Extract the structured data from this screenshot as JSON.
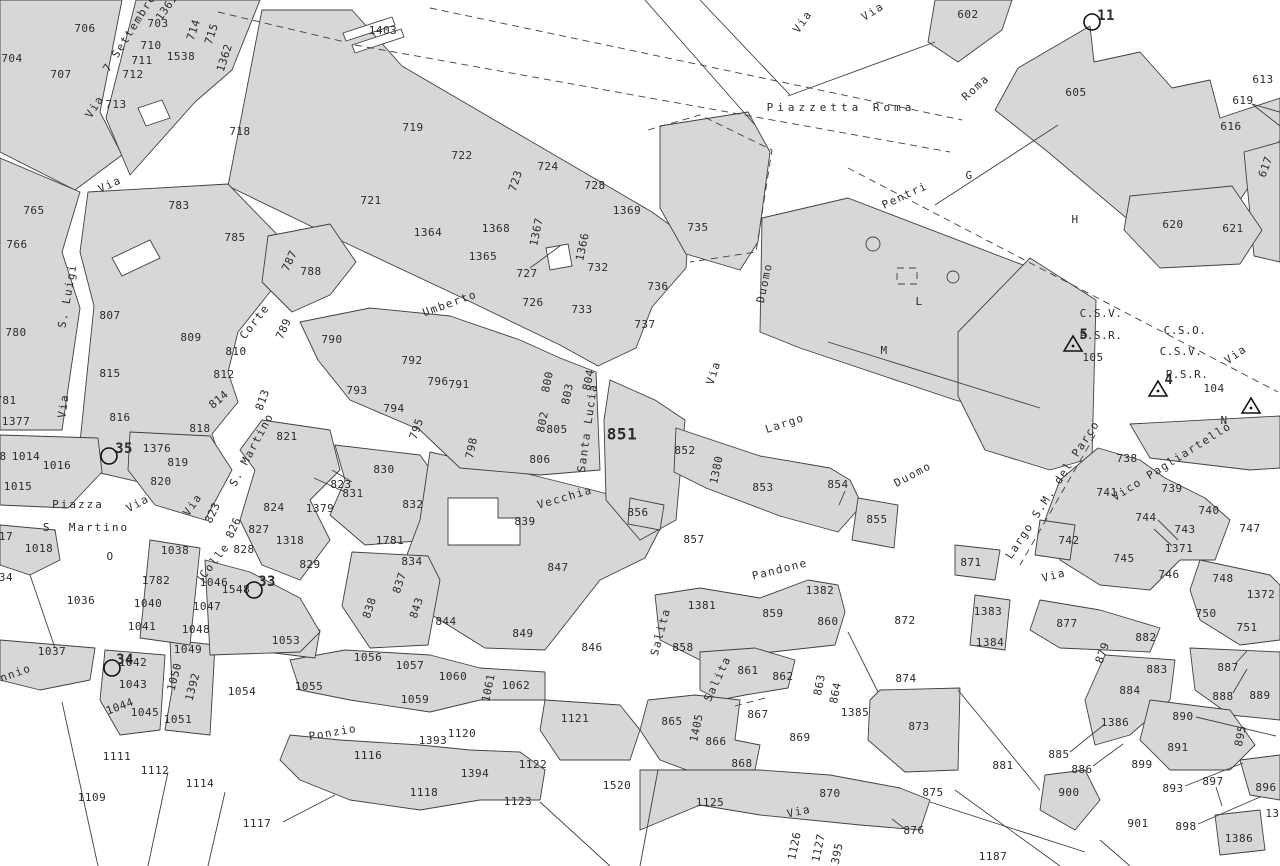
{
  "map": {
    "type": "cadastral-map",
    "background": "#ffffff",
    "parcel_fill": "#d7d7d7",
    "line_color": "#404040",
    "text_color": "#2b2b2b"
  },
  "streets": [
    {
      "t": "7 Settembre",
      "x": 130,
      "y": 33,
      "r": -58
    },
    {
      "t": "Via",
      "x": 95,
      "y": 107,
      "r": -58
    },
    {
      "t": "Via",
      "x": 110,
      "y": 185,
      "r": -25
    },
    {
      "t": "Via",
      "x": 803,
      "y": 22,
      "r": -55
    },
    {
      "t": "Via",
      "x": 873,
      "y": 12,
      "r": -32
    },
    {
      "t": "Roma",
      "x": 976,
      "y": 88,
      "r": -42
    },
    {
      "t": "Pentri",
      "x": 905,
      "y": 196,
      "r": -25
    },
    {
      "t": "Umberto",
      "x": 450,
      "y": 304,
      "r": -20
    },
    {
      "t": "Duomo",
      "x": 765,
      "y": 283,
      "r": -78
    },
    {
      "t": "Via",
      "x": 714,
      "y": 373,
      "r": -72
    },
    {
      "t": "Largo",
      "x": 785,
      "y": 424,
      "r": -18
    },
    {
      "t": "Duomo",
      "x": 913,
      "y": 475,
      "r": -28
    },
    {
      "t": "S. Luigi",
      "x": 68,
      "y": 296,
      "r": -80
    },
    {
      "t": "Corte",
      "x": 255,
      "y": 322,
      "r": -52
    },
    {
      "t": "Via",
      "x": 64,
      "y": 406,
      "r": -82
    },
    {
      "t": "S. Martino",
      "x": 252,
      "y": 450,
      "r": -62
    },
    {
      "t": "Via",
      "x": 138,
      "y": 504,
      "r": -28
    },
    {
      "t": "Via",
      "x": 193,
      "y": 505,
      "r": -55
    },
    {
      "t": "Colle",
      "x": 215,
      "y": 561,
      "r": -52
    },
    {
      "t": "Vecchia",
      "x": 565,
      "y": 498,
      "r": -16
    },
    {
      "t": "Santa Lucia",
      "x": 588,
      "y": 428,
      "r": -82
    },
    {
      "t": "Pandone",
      "x": 780,
      "y": 570,
      "r": -14
    },
    {
      "t": "Salita",
      "x": 661,
      "y": 632,
      "r": -75
    },
    {
      "t": "Salita",
      "x": 718,
      "y": 679,
      "r": -65
    },
    {
      "t": "Ponzio",
      "x": 333,
      "y": 733,
      "r": -10
    },
    {
      "t": "ennio",
      "x": 12,
      "y": 675,
      "r": -20
    },
    {
      "t": "Via",
      "x": 1054,
      "y": 576,
      "r": -14
    },
    {
      "t": "Via",
      "x": 1236,
      "y": 355,
      "r": -35
    },
    {
      "t": "Vico Pagliartello",
      "x": 1172,
      "y": 462,
      "r": -32
    },
    {
      "t": "Largo S.M. del Parco",
      "x": 1053,
      "y": 490,
      "r": -57
    },
    {
      "t": "Via",
      "x": 799,
      "y": 812,
      "r": -12
    }
  ],
  "places": [
    {
      "t": "Piazzetta Roma",
      "x": 841,
      "y": 108,
      "sp": 4
    },
    {
      "t": "Piazza",
      "x": 78,
      "y": 505,
      "sp": 2
    },
    {
      "t": "S. Martino",
      "x": 86,
      "y": 528,
      "sp": 2
    }
  ],
  "areas": [
    {
      "t": "G",
      "x": 969,
      "y": 176
    },
    {
      "t": "H",
      "x": 1075,
      "y": 220
    },
    {
      "t": "M",
      "x": 884,
      "y": 351
    },
    {
      "t": "L",
      "x": 919,
      "y": 302
    },
    {
      "t": "N",
      "x": 1224,
      "y": 421
    },
    {
      "t": "O",
      "x": 110,
      "y": 557
    },
    {
      "t": "C.S.V.",
      "x": 1101,
      "y": 314
    },
    {
      "t": "P.S.R.",
      "x": 1101,
      "y": 336
    },
    {
      "t": "105",
      "x": 1093,
      "y": 358
    },
    {
      "t": "C.S.O.",
      "x": 1185,
      "y": 331
    },
    {
      "t": "C.S.V.",
      "x": 1181,
      "y": 352
    },
    {
      "t": "P.S.R.",
      "x": 1187,
      "y": 375
    },
    {
      "t": "104",
      "x": 1214,
      "y": 389
    }
  ],
  "parcels": [
    {
      "t": "706",
      "x": 85,
      "y": 29
    },
    {
      "t": "703",
      "x": 158,
      "y": 24
    },
    {
      "t": "1361",
      "x": 167,
      "y": 8,
      "r": -55
    },
    {
      "t": "714",
      "x": 194,
      "y": 30,
      "r": -72
    },
    {
      "t": "715",
      "x": 212,
      "y": 34,
      "r": -72
    },
    {
      "t": "710",
      "x": 151,
      "y": 46
    },
    {
      "t": "1538",
      "x": 181,
      "y": 57
    },
    {
      "t": "711",
      "x": 142,
      "y": 61
    },
    {
      "t": "1362",
      "x": 225,
      "y": 58,
      "r": -72
    },
    {
      "t": "712",
      "x": 133,
      "y": 75
    },
    {
      "t": "704",
      "x": 12,
      "y": 59
    },
    {
      "t": "707",
      "x": 61,
      "y": 75
    },
    {
      "t": "713",
      "x": 116,
      "y": 105
    },
    {
      "t": "718",
      "x": 240,
      "y": 132
    },
    {
      "t": "1403",
      "x": 383,
      "y": 31
    },
    {
      "t": "719",
      "x": 413,
      "y": 128
    },
    {
      "t": "722",
      "x": 462,
      "y": 156
    },
    {
      "t": "721",
      "x": 371,
      "y": 201
    },
    {
      "t": "723",
      "x": 516,
      "y": 181,
      "r": -72
    },
    {
      "t": "724",
      "x": 548,
      "y": 167
    },
    {
      "t": "728",
      "x": 595,
      "y": 186
    },
    {
      "t": "1369",
      "x": 627,
      "y": 211
    },
    {
      "t": "765",
      "x": 34,
      "y": 211
    },
    {
      "t": "783",
      "x": 179,
      "y": 206
    },
    {
      "t": "766",
      "x": 17,
      "y": 245
    },
    {
      "t": "785",
      "x": 235,
      "y": 238
    },
    {
      "t": "787",
      "x": 290,
      "y": 261,
      "r": -65
    },
    {
      "t": "788",
      "x": 311,
      "y": 272
    },
    {
      "t": "807",
      "x": 110,
      "y": 316
    },
    {
      "t": "780",
      "x": 16,
      "y": 333
    },
    {
      "t": "809",
      "x": 191,
      "y": 338
    },
    {
      "t": "810",
      "x": 236,
      "y": 352
    },
    {
      "t": "789",
      "x": 284,
      "y": 329,
      "r": -65
    },
    {
      "t": "812",
      "x": 224,
      "y": 375
    },
    {
      "t": "815",
      "x": 110,
      "y": 374
    },
    {
      "t": "814",
      "x": 219,
      "y": 400,
      "r": -40
    },
    {
      "t": "813",
      "x": 263,
      "y": 400,
      "r": -70
    },
    {
      "t": "781",
      "x": 6,
      "y": 401
    },
    {
      "t": "1377",
      "x": 16,
      "y": 422
    },
    {
      "t": "816",
      "x": 120,
      "y": 418
    },
    {
      "t": "818",
      "x": 200,
      "y": 429
    },
    {
      "t": "1364",
      "x": 428,
      "y": 233
    },
    {
      "t": "1368",
      "x": 496,
      "y": 229
    },
    {
      "t": "1367",
      "x": 537,
      "y": 232,
      "r": -78
    },
    {
      "t": "1366",
      "x": 583,
      "y": 247,
      "r": -78
    },
    {
      "t": "1365",
      "x": 483,
      "y": 257
    },
    {
      "t": "727",
      "x": 527,
      "y": 274
    },
    {
      "t": "732",
      "x": 598,
      "y": 268
    },
    {
      "t": "726",
      "x": 533,
      "y": 303
    },
    {
      "t": "733",
      "x": 582,
      "y": 310
    },
    {
      "t": "790",
      "x": 332,
      "y": 340
    },
    {
      "t": "792",
      "x": 412,
      "y": 361
    },
    {
      "t": "796",
      "x": 438,
      "y": 382
    },
    {
      "t": "791",
      "x": 459,
      "y": 385
    },
    {
      "t": "793",
      "x": 357,
      "y": 391
    },
    {
      "t": "794",
      "x": 394,
      "y": 409
    },
    {
      "t": "795",
      "x": 417,
      "y": 429,
      "r": -70
    },
    {
      "t": "800",
      "x": 548,
      "y": 382,
      "r": -78
    },
    {
      "t": "803",
      "x": 568,
      "y": 394,
      "r": -78
    },
    {
      "t": "804",
      "x": 589,
      "y": 380,
      "r": -78
    },
    {
      "t": "802",
      "x": 543,
      "y": 422,
      "r": -78
    },
    {
      "t": "805",
      "x": 557,
      "y": 430
    },
    {
      "t": "806",
      "x": 540,
      "y": 460
    },
    {
      "t": "735",
      "x": 698,
      "y": 228
    },
    {
      "t": "736",
      "x": 658,
      "y": 287
    },
    {
      "t": "737",
      "x": 645,
      "y": 325
    },
    {
      "t": "602",
      "x": 968,
      "y": 15
    },
    {
      "t": "605",
      "x": 1076,
      "y": 93
    },
    {
      "t": "613",
      "x": 1263,
      "y": 80
    },
    {
      "t": "619",
      "x": 1243,
      "y": 101
    },
    {
      "t": "616",
      "x": 1231,
      "y": 127
    },
    {
      "t": "617",
      "x": 1266,
      "y": 167,
      "r": -70
    },
    {
      "t": "620",
      "x": 1173,
      "y": 225
    },
    {
      "t": "621",
      "x": 1233,
      "y": 229
    },
    {
      "t": "8",
      "x": 3,
      "y": 457
    },
    {
      "t": "1014",
      "x": 26,
      "y": 457
    },
    {
      "t": "1016",
      "x": 57,
      "y": 466
    },
    {
      "t": "1015",
      "x": 18,
      "y": 487
    },
    {
      "t": "1376",
      "x": 157,
      "y": 449
    },
    {
      "t": "819",
      "x": 178,
      "y": 463
    },
    {
      "t": "820",
      "x": 161,
      "y": 482
    },
    {
      "t": "821",
      "x": 287,
      "y": 437
    },
    {
      "t": "823",
      "x": 213,
      "y": 513,
      "r": -65
    },
    {
      "t": "824",
      "x": 274,
      "y": 508
    },
    {
      "t": "826",
      "x": 234,
      "y": 528,
      "r": -65
    },
    {
      "t": "827",
      "x": 259,
      "y": 530
    },
    {
      "t": "828",
      "x": 244,
      "y": 550
    },
    {
      "t": "1318",
      "x": 290,
      "y": 541
    },
    {
      "t": "829",
      "x": 310,
      "y": 565
    },
    {
      "t": "17",
      "x": 6,
      "y": 537
    },
    {
      "t": "1018",
      "x": 39,
      "y": 549
    },
    {
      "t": "34",
      "x": 6,
      "y": 578
    },
    {
      "t": "1036",
      "x": 81,
      "y": 601
    },
    {
      "t": "1038",
      "x": 175,
      "y": 551
    },
    {
      "t": "1782",
      "x": 156,
      "y": 581
    },
    {
      "t": "1046",
      "x": 214,
      "y": 583
    },
    {
      "t": "1548",
      "x": 236,
      "y": 590
    },
    {
      "t": "1040",
      "x": 148,
      "y": 604
    },
    {
      "t": "1047",
      "x": 207,
      "y": 607
    },
    {
      "t": "1041",
      "x": 142,
      "y": 627
    },
    {
      "t": "1048",
      "x": 196,
      "y": 630
    },
    {
      "t": "1053",
      "x": 286,
      "y": 641
    },
    {
      "t": "798",
      "x": 472,
      "y": 448,
      "r": -78
    },
    {
      "t": "830",
      "x": 384,
      "y": 470
    },
    {
      "t": "823",
      "x": 341,
      "y": 485
    },
    {
      "t": "831",
      "x": 353,
      "y": 494
    },
    {
      "t": "832",
      "x": 413,
      "y": 505
    },
    {
      "t": "1379",
      "x": 320,
      "y": 509
    },
    {
      "t": "839",
      "x": 525,
      "y": 522
    },
    {
      "t": "1781",
      "x": 390,
      "y": 541
    },
    {
      "t": "834",
      "x": 412,
      "y": 562
    },
    {
      "t": "837",
      "x": 400,
      "y": 583,
      "r": -72
    },
    {
      "t": "838",
      "x": 370,
      "y": 608,
      "r": -72
    },
    {
      "t": "843",
      "x": 417,
      "y": 608,
      "r": -72
    },
    {
      "t": "844",
      "x": 446,
      "y": 622
    },
    {
      "t": "849",
      "x": 523,
      "y": 634
    },
    {
      "t": "847",
      "x": 558,
      "y": 568
    },
    {
      "t": "851",
      "x": 622,
      "y": 435,
      "s": 16,
      "w": 600
    },
    {
      "t": "856",
      "x": 638,
      "y": 513
    },
    {
      "t": "852",
      "x": 685,
      "y": 451
    },
    {
      "t": "1380",
      "x": 717,
      "y": 470,
      "r": -78
    },
    {
      "t": "853",
      "x": 763,
      "y": 488
    },
    {
      "t": "854",
      "x": 838,
      "y": 485
    },
    {
      "t": "855",
      "x": 877,
      "y": 520
    },
    {
      "t": "857",
      "x": 694,
      "y": 540
    },
    {
      "t": "1382",
      "x": 820,
      "y": 591
    },
    {
      "t": "1381",
      "x": 702,
      "y": 606
    },
    {
      "t": "859",
      "x": 773,
      "y": 614
    },
    {
      "t": "860",
      "x": 828,
      "y": 622
    },
    {
      "t": "872",
      "x": 905,
      "y": 621
    },
    {
      "t": "858",
      "x": 683,
      "y": 648
    },
    {
      "t": "738",
      "x": 1127,
      "y": 459
    },
    {
      "t": "741",
      "x": 1107,
      "y": 493
    },
    {
      "t": "739",
      "x": 1172,
      "y": 489
    },
    {
      "t": "740",
      "x": 1209,
      "y": 511
    },
    {
      "t": "744",
      "x": 1146,
      "y": 518
    },
    {
      "t": "743",
      "x": 1185,
      "y": 530
    },
    {
      "t": "742",
      "x": 1069,
      "y": 541
    },
    {
      "t": "1371",
      "x": 1179,
      "y": 549
    },
    {
      "t": "745",
      "x": 1124,
      "y": 559
    },
    {
      "t": "746",
      "x": 1169,
      "y": 575
    },
    {
      "t": "747",
      "x": 1250,
      "y": 529
    },
    {
      "t": "748",
      "x": 1223,
      "y": 579
    },
    {
      "t": "1372",
      "x": 1261,
      "y": 595
    },
    {
      "t": "871",
      "x": 971,
      "y": 563
    },
    {
      "t": "750",
      "x": 1206,
      "y": 614
    },
    {
      "t": "751",
      "x": 1247,
      "y": 628
    },
    {
      "t": "1383",
      "x": 988,
      "y": 612
    },
    {
      "t": "877",
      "x": 1067,
      "y": 624
    },
    {
      "t": "1384",
      "x": 990,
      "y": 643
    },
    {
      "t": "882",
      "x": 1146,
      "y": 638
    },
    {
      "t": "879",
      "x": 1103,
      "y": 653,
      "r": -70
    },
    {
      "t": "1037",
      "x": 52,
      "y": 652
    },
    {
      "t": "1042",
      "x": 133,
      "y": 663
    },
    {
      "t": "1043",
      "x": 133,
      "y": 685
    },
    {
      "t": "1044",
      "x": 120,
      "y": 707,
      "r": -20
    },
    {
      "t": "1045",
      "x": 145,
      "y": 713
    },
    {
      "t": "1049",
      "x": 188,
      "y": 650
    },
    {
      "t": "1050",
      "x": 175,
      "y": 677,
      "r": -75
    },
    {
      "t": "1392",
      "x": 193,
      "y": 687,
      "r": -75
    },
    {
      "t": "1051",
      "x": 178,
      "y": 720
    },
    {
      "t": "1054",
      "x": 242,
      "y": 692
    },
    {
      "t": "1055",
      "x": 309,
      "y": 687
    },
    {
      "t": "1111",
      "x": 117,
      "y": 757
    },
    {
      "t": "1112",
      "x": 155,
      "y": 771
    },
    {
      "t": "1114",
      "x": 200,
      "y": 784
    },
    {
      "t": "1109",
      "x": 92,
      "y": 798
    },
    {
      "t": "1117",
      "x": 257,
      "y": 824
    },
    {
      "t": "1056",
      "x": 368,
      "y": 658
    },
    {
      "t": "1057",
      "x": 410,
      "y": 666
    },
    {
      "t": "1060",
      "x": 453,
      "y": 677
    },
    {
      "t": "1061",
      "x": 489,
      "y": 688,
      "r": -78
    },
    {
      "t": "1062",
      "x": 516,
      "y": 686
    },
    {
      "t": "1059",
      "x": 415,
      "y": 700
    },
    {
      "t": "1116",
      "x": 368,
      "y": 756
    },
    {
      "t": "1393",
      "x": 433,
      "y": 741
    },
    {
      "t": "1120",
      "x": 462,
      "y": 734
    },
    {
      "t": "1118",
      "x": 424,
      "y": 793
    },
    {
      "t": "1394",
      "x": 475,
      "y": 774
    },
    {
      "t": "1122",
      "x": 533,
      "y": 765
    },
    {
      "t": "1121",
      "x": 575,
      "y": 719
    },
    {
      "t": "1123",
      "x": 518,
      "y": 802
    },
    {
      "t": "1520",
      "x": 617,
      "y": 786
    },
    {
      "t": "846",
      "x": 592,
      "y": 648
    },
    {
      "t": "861",
      "x": 748,
      "y": 671
    },
    {
      "t": "862",
      "x": 783,
      "y": 677
    },
    {
      "t": "863",
      "x": 820,
      "y": 685,
      "r": -78
    },
    {
      "t": "864",
      "x": 836,
      "y": 693,
      "r": -78
    },
    {
      "t": "874",
      "x": 906,
      "y": 679
    },
    {
      "t": "1385",
      "x": 855,
      "y": 713
    },
    {
      "t": "873",
      "x": 919,
      "y": 727
    },
    {
      "t": "865",
      "x": 672,
      "y": 722
    },
    {
      "t": "1405",
      "x": 697,
      "y": 728,
      "r": -78
    },
    {
      "t": "866",
      "x": 716,
      "y": 742
    },
    {
      "t": "867",
      "x": 758,
      "y": 715
    },
    {
      "t": "868",
      "x": 742,
      "y": 764
    },
    {
      "t": "869",
      "x": 800,
      "y": 738
    },
    {
      "t": "870",
      "x": 830,
      "y": 794
    },
    {
      "t": "1125",
      "x": 710,
      "y": 803
    },
    {
      "t": "1126",
      "x": 795,
      "y": 846,
      "r": -78
    },
    {
      "t": "1127",
      "x": 819,
      "y": 848,
      "r": -78
    },
    {
      "t": "1395",
      "x": 837,
      "y": 857,
      "r": -78
    },
    {
      "t": "875",
      "x": 933,
      "y": 793
    },
    {
      "t": "876",
      "x": 914,
      "y": 831
    },
    {
      "t": "883",
      "x": 1157,
      "y": 670
    },
    {
      "t": "887",
      "x": 1228,
      "y": 668
    },
    {
      "t": "884",
      "x": 1130,
      "y": 691
    },
    {
      "t": "888",
      "x": 1223,
      "y": 697
    },
    {
      "t": "889",
      "x": 1260,
      "y": 696
    },
    {
      "t": "890",
      "x": 1183,
      "y": 717
    },
    {
      "t": "1386",
      "x": 1115,
      "y": 723
    },
    {
      "t": "895",
      "x": 1241,
      "y": 736,
      "r": -78
    },
    {
      "t": "891",
      "x": 1178,
      "y": 748
    },
    {
      "t": "885",
      "x": 1059,
      "y": 755
    },
    {
      "t": "886",
      "x": 1082,
      "y": 770
    },
    {
      "t": "899",
      "x": 1142,
      "y": 765
    },
    {
      "t": "881",
      "x": 1003,
      "y": 766
    },
    {
      "t": "893",
      "x": 1173,
      "y": 789
    },
    {
      "t": "897",
      "x": 1213,
      "y": 782
    },
    {
      "t": "896",
      "x": 1266,
      "y": 788
    },
    {
      "t": "900",
      "x": 1069,
      "y": 793
    },
    {
      "t": "901",
      "x": 1138,
      "y": 824
    },
    {
      "t": "898",
      "x": 1186,
      "y": 827
    },
    {
      "t": "1386",
      "x": 1239,
      "y": 839
    },
    {
      "t": "1187",
      "x": 993,
      "y": 857
    },
    {
      "t": "138",
      "x": 1276,
      "y": 814
    }
  ],
  "markers": {
    "circles": [
      {
        "label": "11",
        "cx": 1092,
        "cy": 22,
        "lx": 1106,
        "ly": 16
      },
      {
        "label": "35",
        "cx": 109,
        "cy": 456,
        "lx": 124,
        "ly": 449
      },
      {
        "label": "33",
        "cx": 254,
        "cy": 590,
        "lx": 267,
        "ly": 582
      },
      {
        "label": "34",
        "cx": 112,
        "cy": 668,
        "lx": 125,
        "ly": 660
      }
    ],
    "triangles": [
      {
        "label": "5",
        "cx": 1073,
        "cy": 345,
        "lx": 1084,
        "ly": 335
      },
      {
        "label": "4",
        "cx": 1158,
        "cy": 390,
        "lx": 1169,
        "ly": 380
      },
      {
        "label": "",
        "cx": 1251,
        "cy": 407,
        "lx": 0,
        "ly": 0
      }
    ]
  }
}
